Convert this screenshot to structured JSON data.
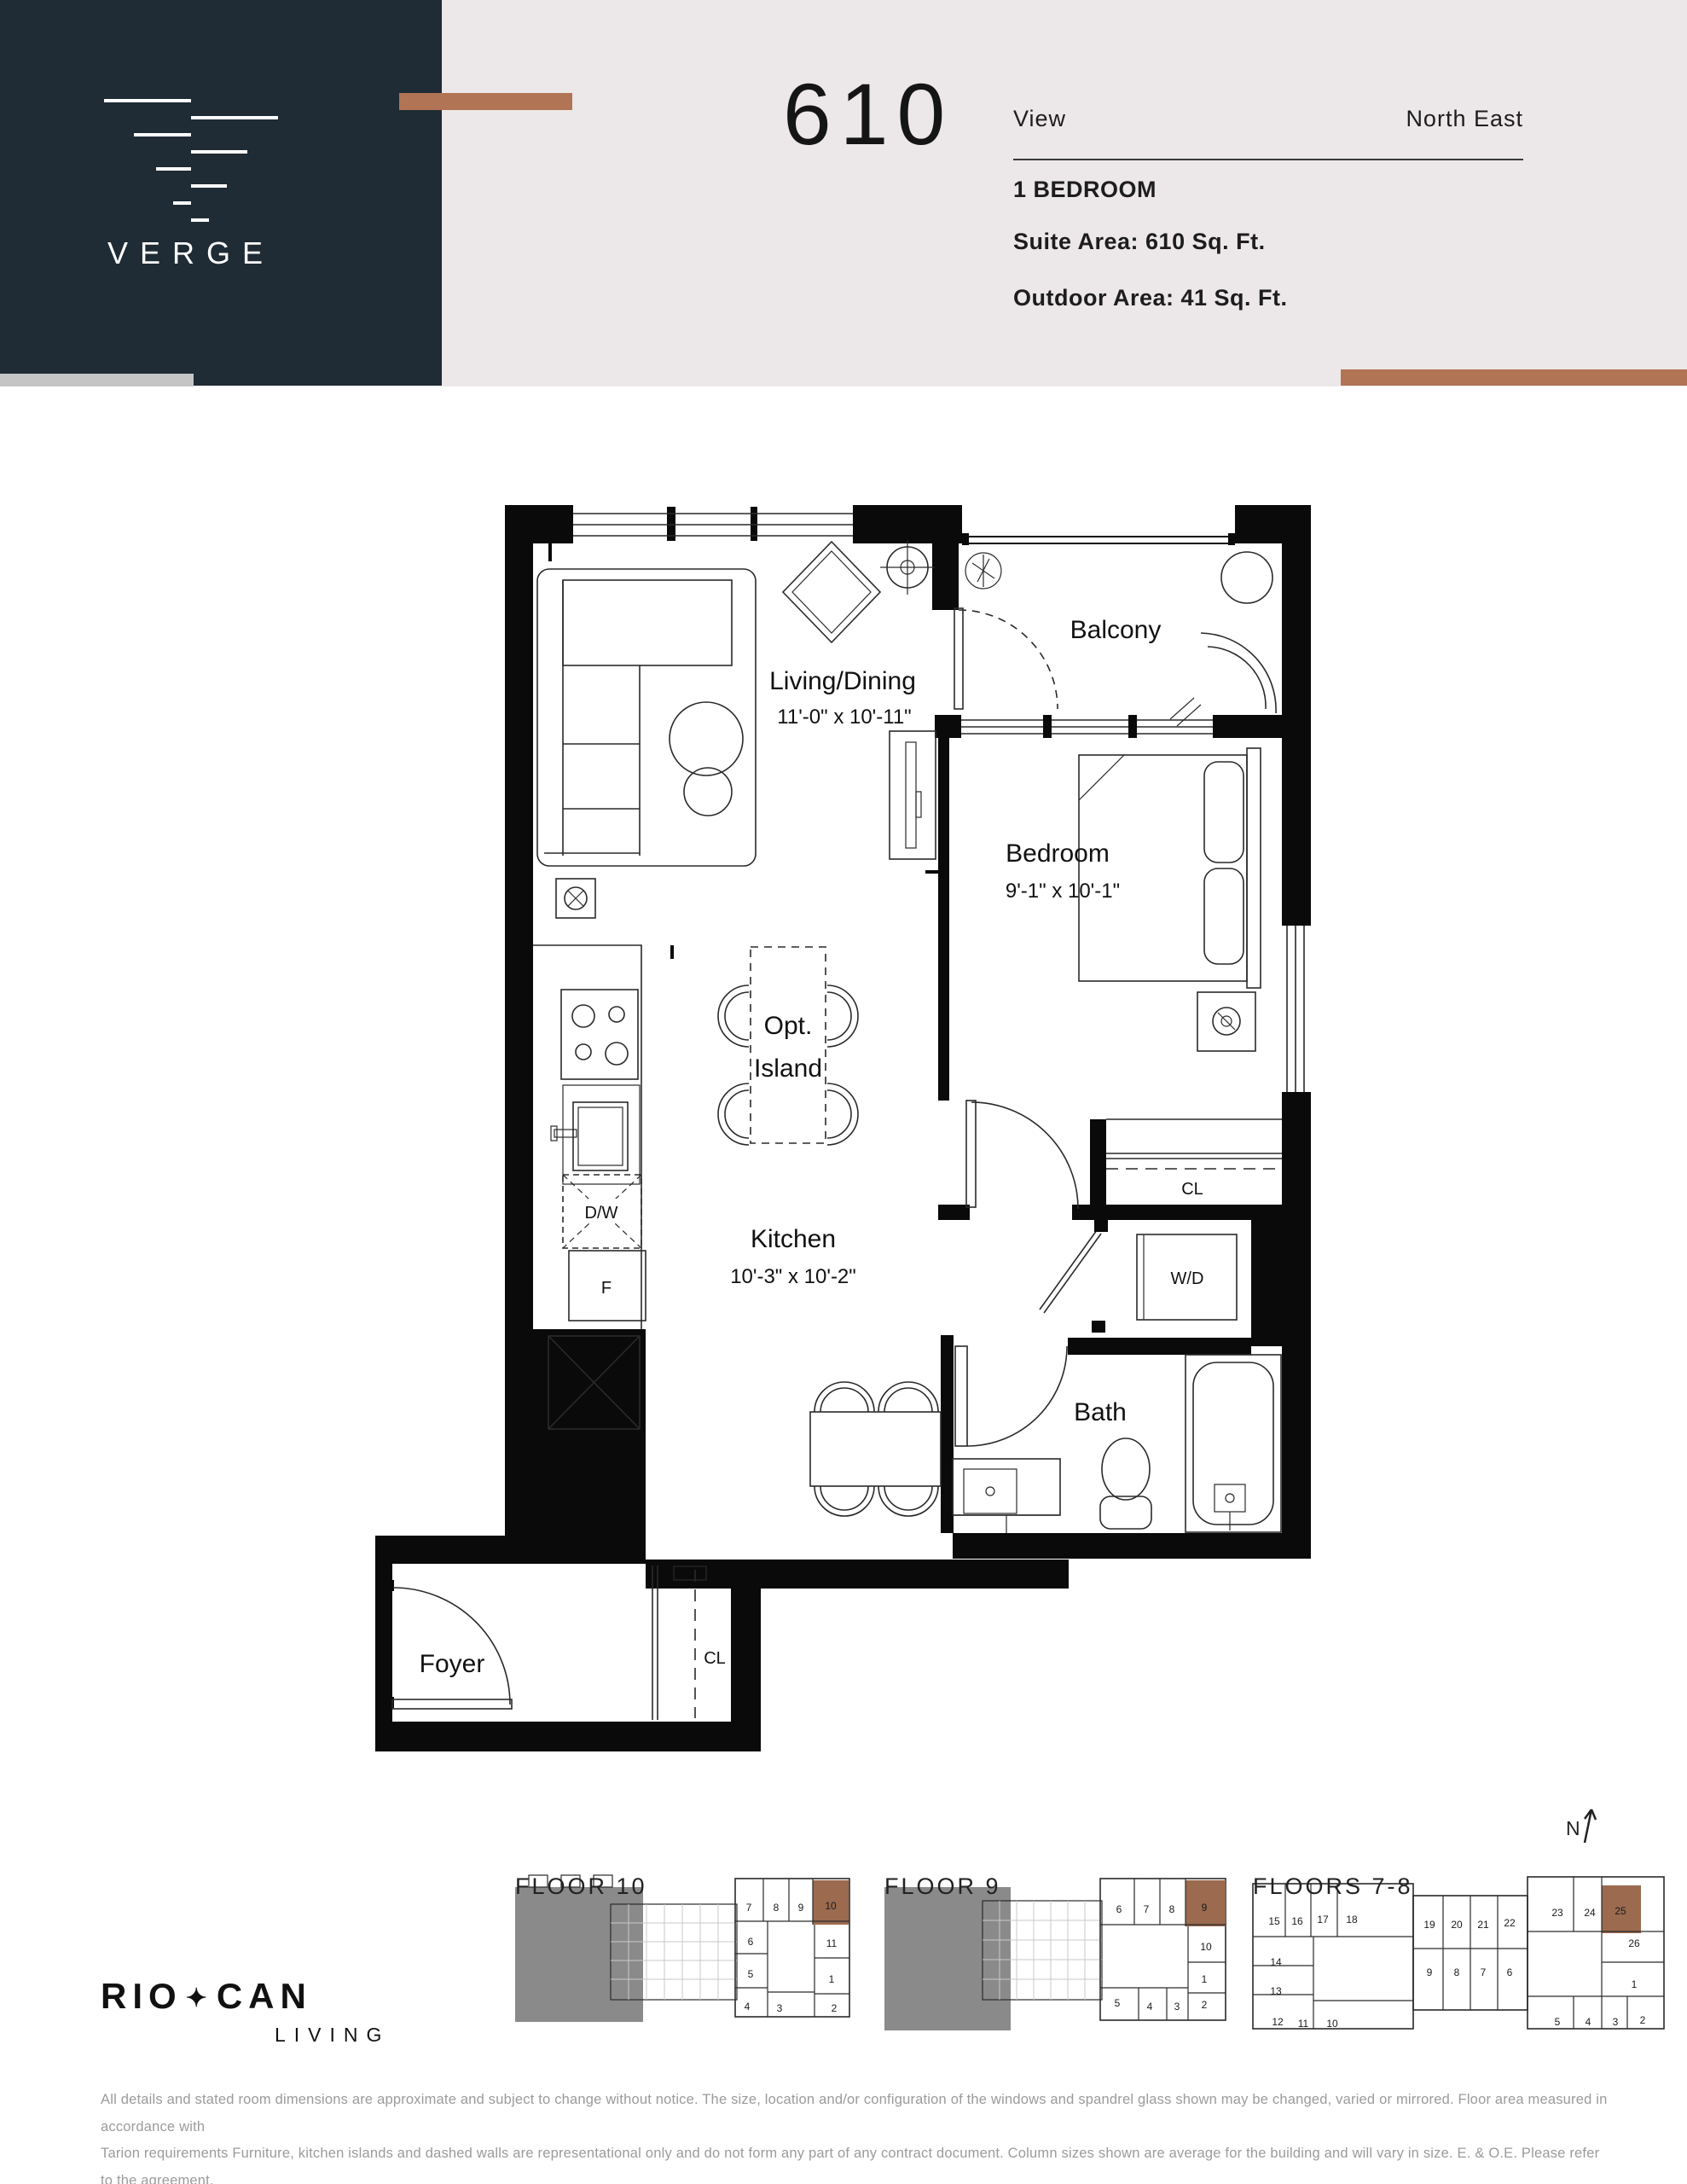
{
  "colors": {
    "navy": "#1f2b35",
    "copper": "#b17455",
    "beige": "#ece7e8",
    "keyplan_highlight": "#9b6a4f",
    "gray_mass": "#8a8a8a"
  },
  "brand": {
    "name": "VERGE"
  },
  "header": {
    "unit_number": "610",
    "view_label": "View",
    "view_value": "North East",
    "type": "1 BEDROOM",
    "suite_area": "Suite Area: 610 Sq. Ft.",
    "outdoor_area": "Outdoor Area: 41 Sq. Ft."
  },
  "plan": {
    "living": {
      "name": "Living/Dining",
      "dims": "11'-0\" x 10'-11\""
    },
    "balcony": {
      "name": "Balcony"
    },
    "bedroom": {
      "name": "Bedroom",
      "dims": "9'-1\" x 10'-1\""
    },
    "kitchen": {
      "name": "Kitchen",
      "dims": "10'-3\" x 10'-2\""
    },
    "island": {
      "line1": "Opt.",
      "line2": "Island"
    },
    "bath": {
      "name": "Bath"
    },
    "foyer": {
      "name": "Foyer"
    },
    "wd": "W/D",
    "dw": "D/W",
    "fridge": "F",
    "closet_bedroom": "CL",
    "closet_foyer": "CL"
  },
  "keyplans": {
    "north_label": "N",
    "floor10": {
      "title": "FLOOR 10",
      "highlight": "10",
      "units": [
        "7",
        "8",
        "9",
        "10",
        "11",
        "1",
        "2",
        "6",
        "5",
        "4",
        "3"
      ]
    },
    "floor9": {
      "title": "FLOOR 9",
      "highlight": "9",
      "units": [
        "6",
        "7",
        "8",
        "9",
        "10",
        "1",
        "5",
        "4",
        "3",
        "2"
      ]
    },
    "floors78": {
      "title": "FLOORS 7-8",
      "highlight": "25",
      "units": [
        "15",
        "16",
        "17",
        "18",
        "19",
        "20",
        "21",
        "22",
        "23",
        "24",
        "25",
        "26",
        "14",
        "13",
        "12",
        "11",
        "10",
        "9",
        "8",
        "7",
        "6",
        "1",
        "5",
        "4",
        "3",
        "2"
      ]
    }
  },
  "footer": {
    "logo_part1": "RIO",
    "logo_leaf": "✦",
    "logo_part2": "CAN",
    "logo_sub": "LIVING",
    "disclaimer_line1": "All details and stated room dimensions are approximate and subject to change without notice. The size, location and/or configuration of the windows and spandrel glass shown may be changed, varied or mirrored. Floor area measured in accordance with",
    "disclaimer_line2": "Tarion requirements Furniture, kitchen islands and dashed walls are representational only and do not form any part of any contract document.  Column sizes shown are average for the building and will vary in size. E. & O.E. Please refer to the agreement."
  }
}
